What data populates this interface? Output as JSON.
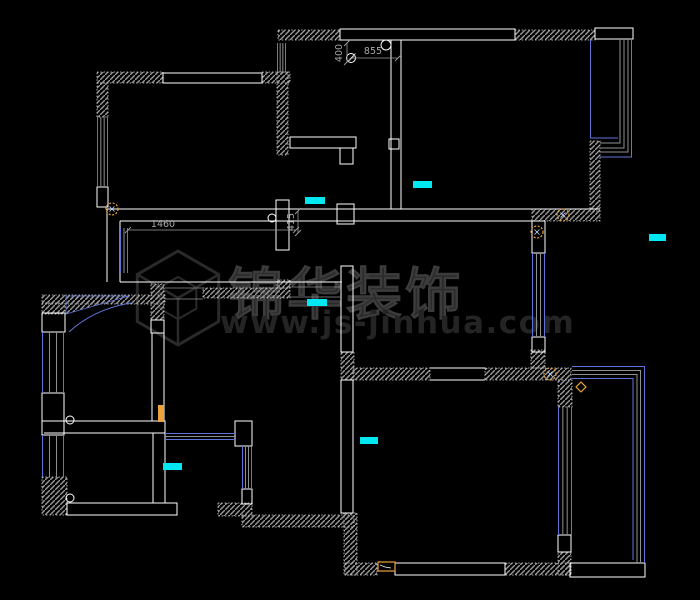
{
  "meta": {
    "width": 700,
    "height": 600,
    "background": "#000000"
  },
  "colors": {
    "wall_outline": "#ffffff",
    "hatch_fill": "#989898",
    "hatch_edge": "#d6d6d6",
    "window_blue": "#5f74d8",
    "window_gray": "#8f8f8f",
    "marker_cyan": "#00e8f2",
    "symbol_orange": "#eca33c",
    "dim_gray": "#9c9c9c",
    "watermark_gray": "#2a2a2a"
  },
  "watermark": {
    "brand": "锦华装饰",
    "url": "www.js-jinhua.com"
  },
  "dimensions": [
    {
      "text": "1460",
      "line": [
        128,
        230,
        296,
        230
      ],
      "orient": "h"
    },
    {
      "text": "415",
      "line": [
        298,
        211,
        298,
        233
      ],
      "orient": "v"
    },
    {
      "text": "855",
      "line": [
        352,
        58,
        398,
        58
      ],
      "orient": "h"
    },
    {
      "text": "400",
      "line": [
        347,
        43,
        347,
        62
      ],
      "orient": "v"
    }
  ],
  "plan": {
    "hatched_rects": [
      [
        97,
        72,
        66,
        11
      ],
      [
        262,
        72,
        28,
        11
      ],
      [
        97,
        83,
        11,
        34
      ],
      [
        278,
        30,
        62,
        10
      ],
      [
        515,
        30,
        80,
        10
      ],
      [
        277,
        72,
        11,
        83
      ],
      [
        532,
        209,
        68,
        12
      ],
      [
        590,
        141,
        10,
        70
      ],
      [
        42,
        295,
        123,
        9
      ],
      [
        42,
        303,
        23,
        11
      ],
      [
        151,
        284,
        13,
        36
      ],
      [
        203,
        288,
        87,
        10
      ],
      [
        277,
        280,
        13,
        8
      ],
      [
        341,
        352,
        13,
        28
      ],
      [
        344,
        513,
        13,
        62
      ],
      [
        242,
        515,
        112,
        12
      ],
      [
        218,
        503,
        34,
        13
      ],
      [
        42,
        477,
        25,
        38
      ],
      [
        353,
        368,
        77,
        12
      ],
      [
        485,
        368,
        86,
        12
      ],
      [
        531,
        350,
        14,
        18
      ],
      [
        558,
        380,
        14,
        27
      ],
      [
        558,
        552,
        13,
        23
      ],
      [
        505,
        563,
        66,
        12
      ],
      [
        345,
        563,
        32,
        12
      ]
    ],
    "hatch_polys": [
      "66,296 129,296 66,314"
    ],
    "outline_rects": [
      [
        163,
        73,
        99,
        10
      ],
      [
        340,
        29,
        175,
        11
      ],
      [
        595,
        28,
        38,
        11
      ],
      [
        276,
        200,
        13,
        50
      ],
      [
        337,
        204,
        17,
        20
      ],
      [
        389,
        139,
        10,
        10
      ],
      [
        290,
        137,
        66,
        11
      ],
      [
        340,
        148,
        13,
        16
      ],
      [
        341,
        266,
        12,
        86
      ],
      [
        341,
        380,
        12,
        133
      ],
      [
        97,
        187,
        11,
        20
      ],
      [
        42,
        313,
        23,
        19
      ],
      [
        42,
        393,
        22,
        28
      ],
      [
        64,
        421,
        101,
        12
      ],
      [
        42,
        421,
        22,
        14
      ],
      [
        151,
        320,
        13,
        13
      ],
      [
        152,
        333,
        12,
        88
      ],
      [
        532,
        221,
        13,
        32
      ],
      [
        532,
        337,
        13,
        15
      ],
      [
        235,
        421,
        17,
        25
      ],
      [
        242,
        489,
        10,
        15
      ],
      [
        67,
        503,
        110,
        12
      ],
      [
        395,
        563,
        110,
        12
      ],
      [
        570,
        563,
        75,
        14
      ],
      [
        558,
        535,
        13,
        17
      ]
    ],
    "white_lines": [
      [
        107,
        209,
        600,
        209
      ],
      [
        120,
        221,
        532,
        221
      ],
      [
        107,
        209,
        107,
        282
      ],
      [
        120,
        221,
        120,
        282
      ],
      [
        120,
        282,
        342,
        282
      ],
      [
        391,
        40,
        391,
        209
      ],
      [
        401,
        40,
        401,
        209
      ],
      [
        153,
        433,
        153,
        503
      ],
      [
        165,
        433,
        165,
        503
      ],
      [
        430,
        368,
        485,
        368
      ],
      [
        430,
        380,
        485,
        380
      ],
      [
        44,
        433,
        64,
        433
      ]
    ],
    "gray_lines": [
      [
        287,
        287,
        342,
        287
      ],
      [
        287,
        297,
        342,
        297
      ],
      [
        165,
        288,
        203,
        288
      ],
      [
        165,
        299,
        203,
        299
      ]
    ],
    "windows": [
      {
        "o": "v",
        "x": 97,
        "y": 117,
        "w": 11,
        "l": 70
      },
      {
        "o": "v",
        "x": 277,
        "y": 43,
        "w": 9,
        "l": 29
      },
      {
        "o": "v",
        "x": 120,
        "y": 228,
        "w": 8,
        "l": 45
      },
      {
        "o": "v",
        "x": 532,
        "y": 253,
        "w": 13,
        "l": 84
      },
      {
        "o": "v",
        "x": 42,
        "y": 332,
        "w": 22,
        "l": 61
      },
      {
        "o": "v",
        "x": 42,
        "y": 435,
        "w": 22,
        "l": 42
      },
      {
        "o": "v",
        "x": 242,
        "y": 446,
        "w": 10,
        "l": 43
      },
      {
        "o": "v",
        "x": 558,
        "y": 407,
        "w": 14,
        "l": 128
      },
      {
        "o": "h",
        "x": 165,
        "y": 433,
        "w": 7,
        "l": 71
      }
    ],
    "bay_paths": [
      {
        "d": "M590.5,40 L590.5,138 L618,138",
        "c": "blue"
      },
      {
        "d": "M620,39 L620,143 L600,143",
        "c": "gray"
      },
      {
        "d": "M624,39 L624,148 L600,148",
        "c": "gray"
      },
      {
        "d": "M628,39 L628,152 L600,152",
        "c": "gray"
      },
      {
        "d": "M631.5,39 L631.5,157 L600,157",
        "c": "blue"
      },
      {
        "d": "M572,366.5 L644.5,366.5 L644.5,563",
        "c": "blue"
      },
      {
        "d": "M572,370.5 L640.5,370.5 L640.5,563",
        "c": "gray"
      },
      {
        "d": "M572,374.5 L637,374.5 L637,563",
        "c": "gray"
      },
      {
        "d": "M572,378.5 L633,378.5 L633,560",
        "c": "blue"
      }
    ],
    "door_arcs": [
      {
        "d": "M131,303 Q94,309 69,332"
      }
    ],
    "cyan_markers": [
      [
        305,
        197,
        20,
        7
      ],
      [
        413,
        181,
        19,
        7
      ],
      [
        307,
        299,
        20,
        7
      ],
      [
        360,
        437,
        18,
        7
      ],
      [
        163,
        463,
        19,
        7
      ],
      [
        649,
        234,
        17,
        7
      ]
    ],
    "circles": [
      [
        386,
        45,
        5
      ],
      [
        272,
        218,
        4
      ],
      [
        70,
        420,
        4
      ],
      [
        70,
        498,
        4
      ]
    ],
    "circle_cross": [
      [
        351,
        58,
        4.5
      ]
    ],
    "orange_circles": [
      [
        112,
        209,
        6
      ],
      [
        563,
        215,
        6
      ],
      [
        537,
        232,
        6
      ],
      [
        550,
        374,
        6
      ]
    ],
    "orange_diamonds": [
      [
        581,
        387,
        3.5
      ]
    ],
    "orange_fill_rects": [
      [
        158,
        405,
        6,
        17
      ]
    ],
    "orange_outline_rects": [
      [
        378,
        562,
        17,
        9
      ]
    ]
  }
}
